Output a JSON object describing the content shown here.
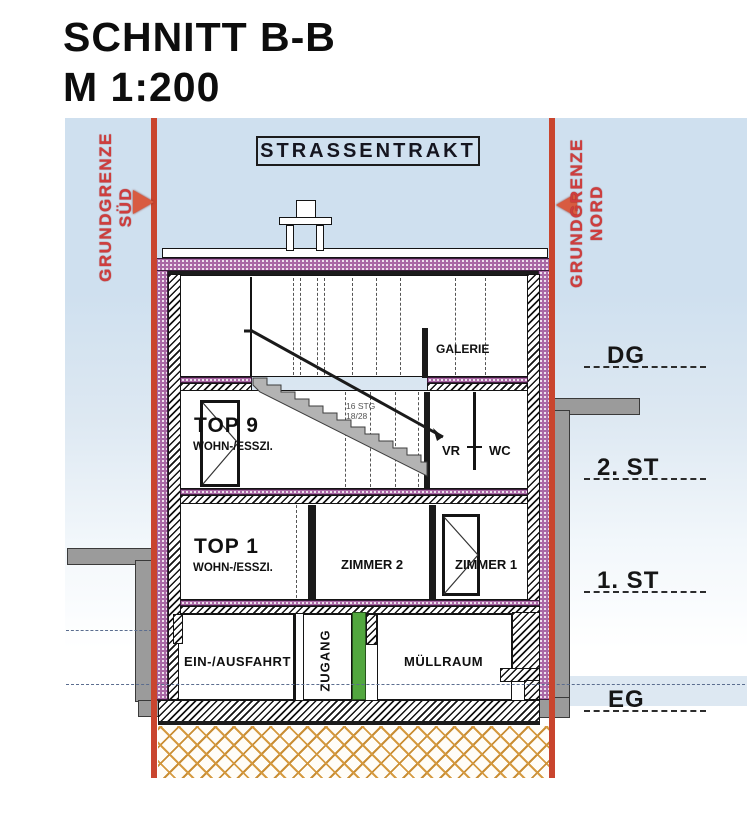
{
  "title": {
    "line1": "SCHNITT B-B",
    "line2": "M 1:200"
  },
  "plan": {
    "header": "STRASSENTRAKT",
    "boundary_left": {
      "name": "GRUNDGRENZE",
      "dir": "SÜD"
    },
    "boundary_right": {
      "name": "GRUNDGRENZE",
      "dir": "NORD"
    },
    "levels": [
      {
        "label": "DG"
      },
      {
        "label": "2. ST"
      },
      {
        "label": "1. ST"
      },
      {
        "label": "EG"
      }
    ],
    "rooms": {
      "galerie": "GALERIE",
      "top9_name": "TOP 9",
      "top9_sub": "WOHN-/ESSZI.",
      "vr": "VR",
      "wc": "WC",
      "top1_name": "TOP 1",
      "top1_sub": "WOHN-/ESSZI.",
      "zimmer2": "ZIMMER 2",
      "zimmer1": "ZIMMER 1",
      "einausfahrt": "EIN-/AUSFAHRT",
      "zugang": "ZUGANG",
      "muellraum": "MÜLLRAUM"
    },
    "stair_note": {
      "line1": "16 STG",
      "line2": "18/28"
    },
    "colors": {
      "sky": "#cfe0ee",
      "boundary_red": "#c9452e",
      "insulation_purple": "#a968a5",
      "neighbor_gray": "#9b9b9b",
      "door_green": "#4aa43c",
      "ground_orange": "#d59a40"
    }
  }
}
